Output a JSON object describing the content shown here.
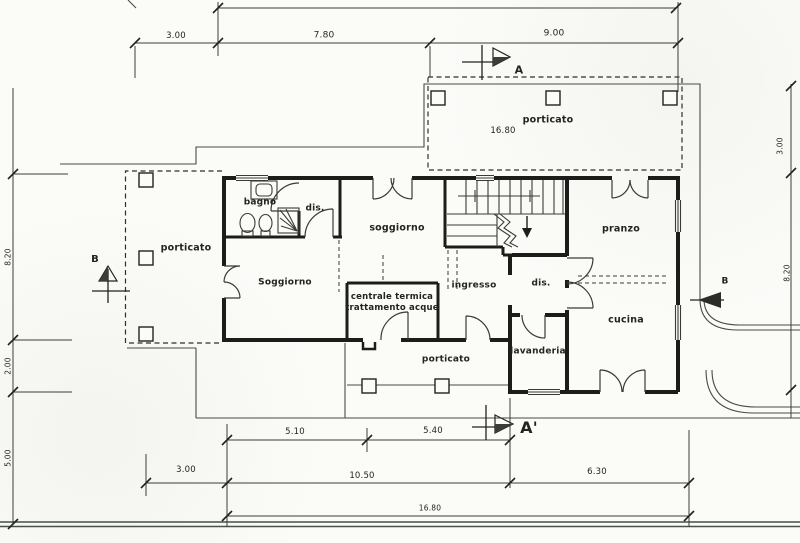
{
  "plan": {
    "rooms": {
      "porticato_top": "porticato",
      "porticato_west": "porticato",
      "porticato_south": "porticato",
      "bagno": "bagno",
      "dis_1": "dis.",
      "soggiorno_upper": "soggiorno",
      "soggiorno_lower": "Soggiorno",
      "centrale_line1": "centrale termica",
      "centrale_line2": "trattamento acque",
      "ingresso": "ingresso",
      "dis_2": "dis.",
      "pranzo": "pranzo",
      "cucina": "cucina",
      "lavanderia": "lavanderia"
    },
    "dimensions": {
      "top": {
        "d1": "3.00",
        "d2": "7.80",
        "d3": "9.00"
      },
      "porticato_width": "16.80",
      "bottom": {
        "d1": "5.10",
        "d2": "5.40",
        "d3": "3.00",
        "d4": "10.50",
        "d5": "6.30",
        "d6": "16.80"
      },
      "left": {
        "d1": "8.20",
        "d2": "2.00",
        "d3": "5.00"
      },
      "right": {
        "d1": "3.00",
        "d2": "8.20"
      }
    },
    "sections": {
      "a": "A",
      "a_prime": "A'",
      "b_left": "B",
      "b_right": "B"
    },
    "colors": {
      "ink": "#2b2b28",
      "wall": "#1c1c1a",
      "paper": "#fbfbf8",
      "road": "#475049"
    }
  }
}
